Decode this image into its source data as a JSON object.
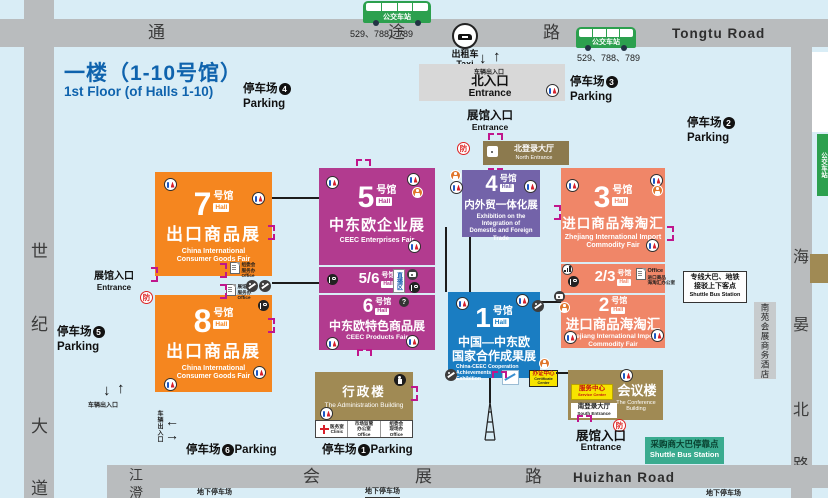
{
  "colors": {
    "bg": "#d9edf6",
    "road": "#b9bcbe",
    "orange": "#f5861f",
    "magenta": "#b23b8f",
    "purple": "#7363a9",
    "salmon": "#f08668",
    "blue": "#1a7dc2",
    "khaki": "#a08a54",
    "brown": "#8c7a4e",
    "teal": "#3aab8f",
    "green": "#2ca04e",
    "yellow": "#f7e400",
    "title": "#0f63ad",
    "gate": "#c0168c",
    "gray_box": "#d8d8d8"
  },
  "title": {
    "zh": "一楼（1-10号馆）",
    "en": "1st Floor (of Halls 1-10)"
  },
  "roads": {
    "top": {
      "c0": "通",
      "c1": "途",
      "c2": "路",
      "en": "Tongtu Road"
    },
    "bottom": {
      "c0": "会",
      "c1": "展",
      "c2": "路",
      "en": "Huizhan Road"
    },
    "left": {
      "c0": "世",
      "c1": "纪",
      "c2": "大",
      "c3": "道"
    },
    "right": {
      "c0": "海",
      "c1": "晏",
      "c2": "北",
      "c3": "路"
    },
    "branch": {
      "c0": "江",
      "c1": "澄"
    }
  },
  "bus": {
    "label": "公交车站",
    "routes": "529、788、789"
  },
  "taxi": {
    "zh": "出租车",
    "en": "Taxi"
  },
  "north_gate": {
    "gate": "车辆出入口",
    "zh": "北入口",
    "en": "Entrance"
  },
  "entrance": {
    "zh": "展馆入口",
    "en": "Entrance"
  },
  "vehicle_gate": "车辆出入口",
  "arrows": {
    "down": "↓",
    "up": "↑",
    "left": "←",
    "right": "→"
  },
  "fire": "防",
  "qmark": "?",
  "halls": {
    "h7": {
      "num": "7",
      "suffix": "号馆",
      "badge": "Hall",
      "title": "出口商品展",
      "sub1": "China International",
      "sub2": "Consumer Goods Fair",
      "color": "#f5861f"
    },
    "h8": {
      "num": "8",
      "suffix": "号馆",
      "badge": "Hall",
      "title": "出口商品展",
      "sub1": "China International",
      "sub2": "Consumer Goods Fair",
      "color": "#f5861f"
    },
    "h5": {
      "num": "5",
      "suffix": "号馆",
      "badge": "Hall",
      "title": "中东欧企业展",
      "sub": "CEEC Enterprises Fair",
      "color": "#b23b8f"
    },
    "h56": {
      "num": "5/6",
      "suffix": "号馆",
      "badge": "Hall",
      "live": "直播区",
      "color": "#b23b8f"
    },
    "h6": {
      "num": "6",
      "suffix": "号馆",
      "badge": "Hall",
      "title": "中东欧特色商品展",
      "sub": "CEEC Products Fair",
      "color": "#b23b8f"
    },
    "h4": {
      "num": "4",
      "suffix": "号馆",
      "badge": "Hall",
      "title": "内外贸一体化展",
      "sub1": "Exhibition on the Integration of",
      "sub2": "Domestic and Foreign Trade",
      "color": "#7363a9"
    },
    "h3": {
      "num": "3",
      "suffix": "号馆",
      "badge": "Hall",
      "title": "进口商品海淘汇",
      "sub1": "Zhejiang International Import",
      "sub2": "Commodity Fair",
      "color": "#f08668"
    },
    "h23": {
      "num": "2/3",
      "suffix": "号馆",
      "badge": "Hall",
      "office_en": "Office",
      "office_zh1": "进口商品",
      "office_zh2": "海淘汇办公室",
      "color": "#f08668"
    },
    "h2": {
      "num": "2",
      "suffix": "号馆",
      "badge": "Hall",
      "title": "进口商品海淘汇",
      "sub1": "Zhejiang International Import",
      "sub2": "Commodity Fair",
      "color": "#f08668"
    },
    "h1": {
      "num": "1",
      "suffix": "号馆",
      "badge": "Hall",
      "title1": "中国—中东欧",
      "title2": "国家合作成果展",
      "sub1": "China-CEEC Cooperation Achievements",
      "sub2": "Exhibition",
      "color": "#1a7dc2"
    }
  },
  "buildings": {
    "north_hall": {
      "zh": "北登录大厅",
      "en": "North Entrance"
    },
    "south_hall": {
      "zh": "南登录大厅",
      "en": "South Entrance"
    },
    "admin": {
      "zh": "行政楼",
      "en": "The Administration Building"
    },
    "conference": {
      "zh": "会议楼",
      "en": "The Conference Building"
    },
    "service": {
      "zh": "服务中心",
      "en": "Service Center"
    },
    "cert": {
      "zh": "办证中心",
      "en": "Certificate Center"
    },
    "clinic": {
      "zh": "医务室",
      "en": "Clinic"
    },
    "office1": {
      "l1": "市场监管",
      "l2": "办公室",
      "en": "Office"
    },
    "office2": {
      "l1": "组委会",
      "l2": "现场办",
      "en": "Office"
    },
    "office3": {
      "l1": "组委会",
      "l2": "服务办",
      "en": "Office"
    },
    "office4": {
      "l1": "展馆",
      "l2": "服务办",
      "en": "Office"
    },
    "hotel": {
      "zh": "南苑会展商务酒店"
    }
  },
  "parking": {
    "label": "停车场",
    "en": "Parking",
    "p1": "1",
    "p2": "2",
    "p3": "3",
    "p4": "4",
    "p5": "5",
    "p6": "6"
  },
  "shuttle": {
    "s1l1": "专线大巴、地铁",
    "s1l2": "接驳上下客点",
    "s1en": "Shuttle Bus Station",
    "s2zh": "采购商大巴停靠点",
    "s2en": "Shuttle Bus Station"
  },
  "underground": "地下停车场"
}
